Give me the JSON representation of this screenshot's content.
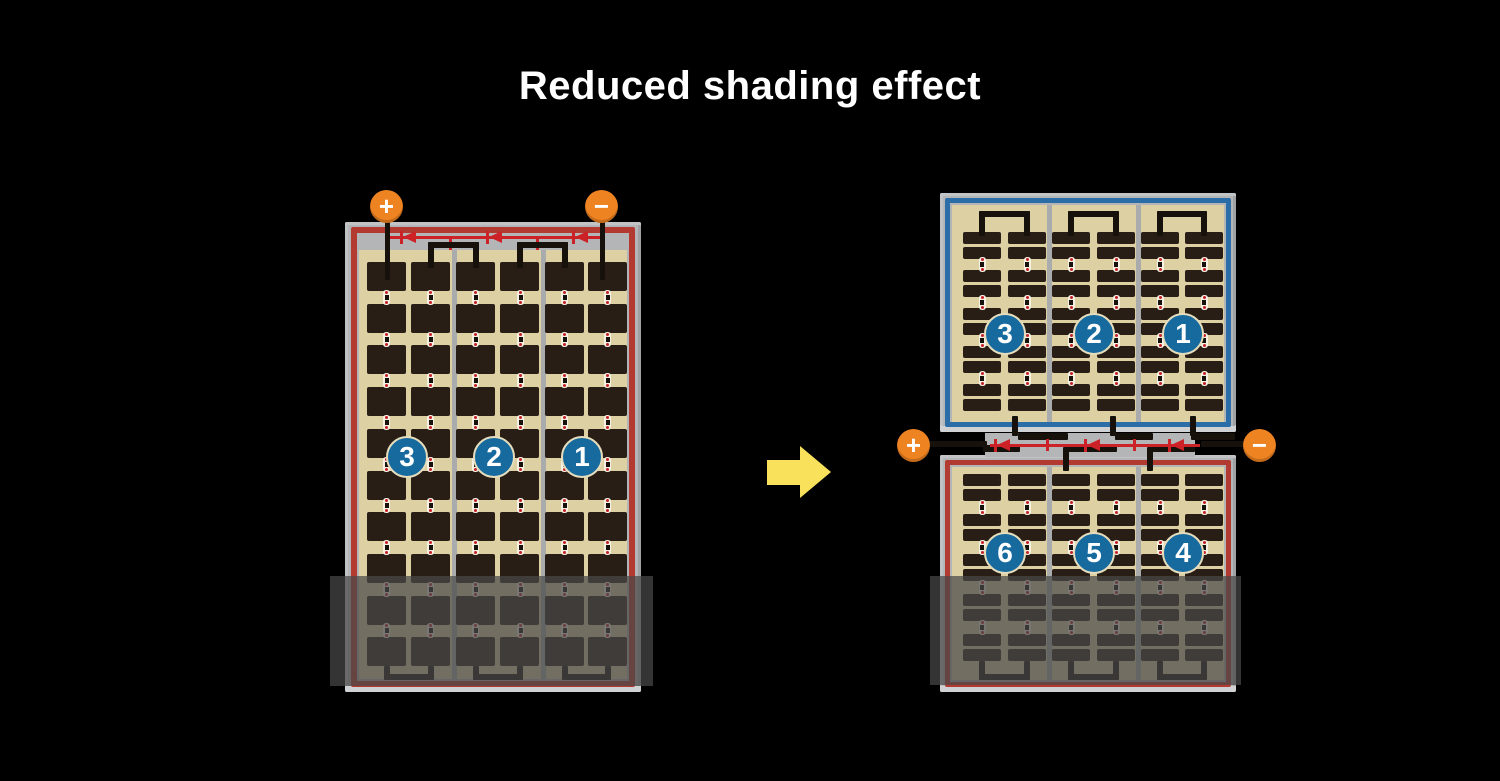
{
  "title": "Reduced shading effect",
  "left_module": {
    "terminals": {
      "positive": "+",
      "negative": "−"
    },
    "strings": [
      "3",
      "2",
      "1"
    ],
    "structure": {
      "string_count": 3,
      "subcolumns_per_string": 2,
      "cell_rows": 10,
      "bypass_diodes": 3
    }
  },
  "arrow": {
    "direction": "right"
  },
  "right_module": {
    "terminals": {
      "positive": "+",
      "negative": "−"
    },
    "top_half": {
      "strings": [
        "3",
        "2",
        "1"
      ],
      "cell_rows": 10
    },
    "bottom_half": {
      "strings": [
        "6",
        "5",
        "4"
      ],
      "cell_rows": 10
    },
    "structure": {
      "string_count": 6,
      "bypass_diodes": 3
    }
  },
  "colors": {
    "background": "#000000",
    "title_text": "#ffffff",
    "panel_frame": "#b4b5b7",
    "cell_backsheet": "#ddd1a3",
    "cell": "#281e16",
    "red_border": "#b23a31",
    "red_wire": "#cc2127",
    "blue_border": "#2b6ea7",
    "number_circle": "#176a9e",
    "terminal": "#ee8322",
    "arrow": "#fae15c",
    "shading_overlay": "rgba(72,72,72,0.72)"
  }
}
